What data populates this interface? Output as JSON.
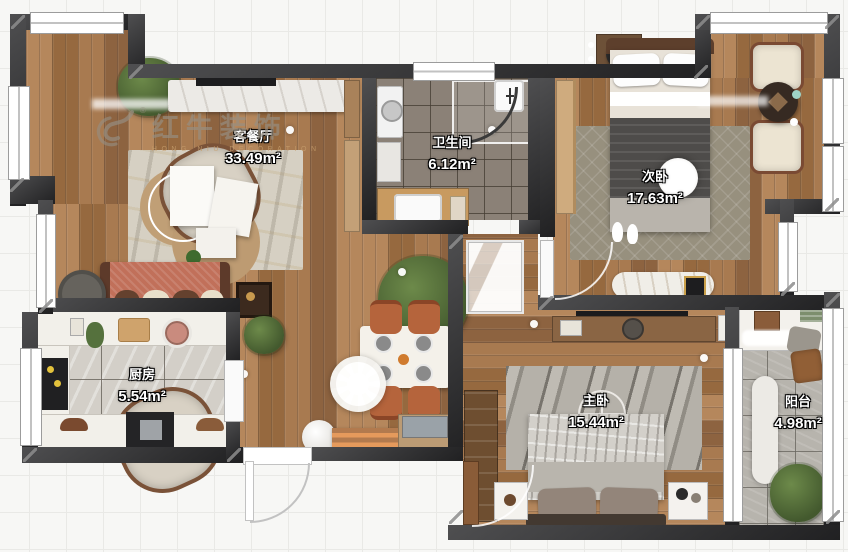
{
  "watermark": {
    "brand": "红牛装饰",
    "subtitle": "HONG NIU DECORATION",
    "registered": "®"
  },
  "rooms": {
    "living": {
      "label": "客餐厅",
      "area": "33.49m²"
    },
    "bathroom": {
      "label": "卫生间",
      "area": "6.12m²"
    },
    "bedroom2": {
      "label": "次卧",
      "area": "17.63m²"
    },
    "kitchen": {
      "label": "厨房",
      "area": "5.54m²"
    },
    "master": {
      "label": "主卧",
      "area": "15.44m²"
    },
    "balcony": {
      "label": "阳台",
      "area": "4.98m²"
    }
  },
  "colors": {
    "wall": "#2d2d2f",
    "wood": "#a1754c",
    "tileBath": "#8b8177",
    "tileKitchen": "#d3cfc8",
    "tileBalcony": "#b7b4ad",
    "sofa": "#c1705a",
    "diningChair": "#b5643c",
    "labelText": "#ffffff",
    "watermarkGray": "#a39a8d"
  }
}
